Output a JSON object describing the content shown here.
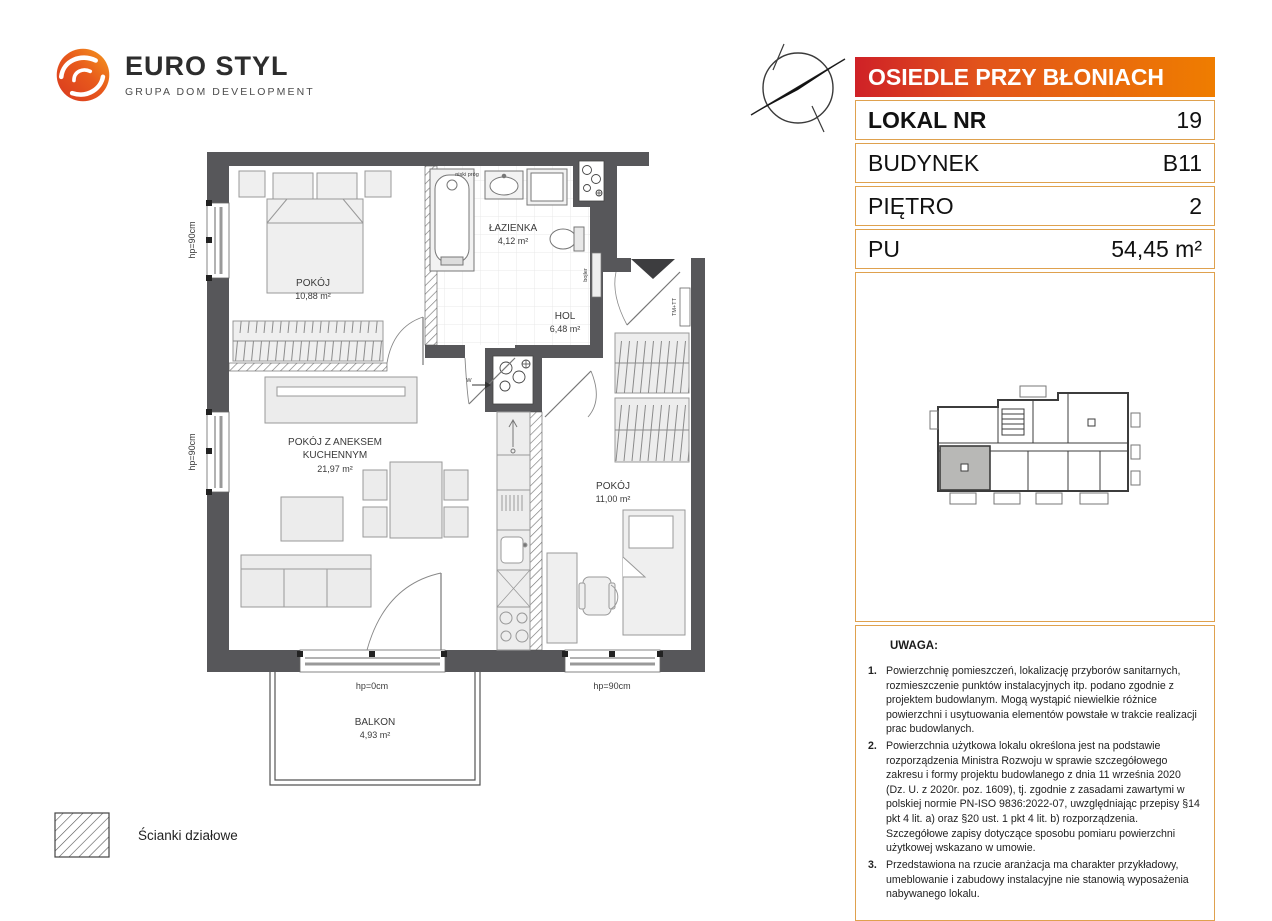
{
  "logo": {
    "title": "EURO STYL",
    "subtitle": "GRUPA DOM DEVELOPMENT"
  },
  "panel": {
    "project_name": "OSIEDLE PRZY BŁONIACH",
    "rows": [
      {
        "label": "LOKAL NR",
        "value": "19"
      },
      {
        "label": "BUDYNEK",
        "value": "B11"
      },
      {
        "label": "PIĘTRO",
        "value": "2"
      },
      {
        "label": "PU",
        "value": "54,45 m²"
      }
    ]
  },
  "plan": {
    "rooms": {
      "bedroom1": {
        "name": "POKÓJ",
        "area": "10,88 m²"
      },
      "bathroom": {
        "name": "ŁAZIENKA",
        "area": "4,12 m²"
      },
      "hall": {
        "name": "HOL",
        "area": "6,48 m²"
      },
      "living": {
        "name_line1": "POKÓJ Z ANEKSEM",
        "name_line2": "KUCHENNYM",
        "area": "21,97 m²"
      },
      "bedroom2": {
        "name": "POKÓJ",
        "area": "11,00 m²"
      },
      "balcony": {
        "name": "BALKON",
        "area": "4,93 m²"
      }
    },
    "labels": {
      "window_left_top": "hp=90cm",
      "window_left_bottom": "hp=90cm",
      "balcony_door": "hp=0cm",
      "window_bottom_right": "hp=90cm",
      "entrance": "TM+TT",
      "threshold": "niski próg",
      "vent": "W",
      "boiler": "bojler"
    }
  },
  "legend": {
    "partition_walls": "Ścianki działowe"
  },
  "notes": {
    "title": "UWAGA:",
    "items": [
      {
        "num": "1.",
        "text": "Powierzchnię pomieszczeń, lokalizację przyborów sanitarnych, rozmieszczenie punktów instalacyjnych itp. podano zgodnie z projektem budowlanym. Mogą wystąpić niewielkie różnice powierzchni i usytuowania elementów powstałe w trakcie realizacji prac budowlanych."
      },
      {
        "num": "2.",
        "text": "Powierzchnia użytkowa lokalu określona jest na podstawie rozporządzenia Ministra Rozwoju w sprawie szczegółowego zakresu i formy projektu budowlanego z dnia 11 września 2020 (Dz. U. z 2020r. poz. 1609), tj. zgodnie z zasadami zawartymi w polskiej normie PN-ISO 9836:2022-07, uwzględniając przepisy §14 pkt 4 lit. a) oraz §20 ust. 1 pkt 4 lit. b) rozporządzenia. Szczegółowe zapisy dotyczące sposobu pomiaru powierzchni użytkowej wskazano w umowie."
      },
      {
        "num": "3.",
        "text": "Przedstawiona na rzucie aranżacja ma charakter przykładowy, umeblowanie i zabudowy instalacyjne nie stanowią wyposażenia nabywanego lokalu."
      }
    ]
  },
  "colors": {
    "header_gradient_left": "#cf2127",
    "header_gradient_right": "#ef7d00",
    "table_border": "#dfa14e",
    "wall": "#57575a",
    "unit_highlight": "#b8b8b6",
    "logo_red": "#d8381f",
    "logo_orange": "#f59a1e"
  }
}
